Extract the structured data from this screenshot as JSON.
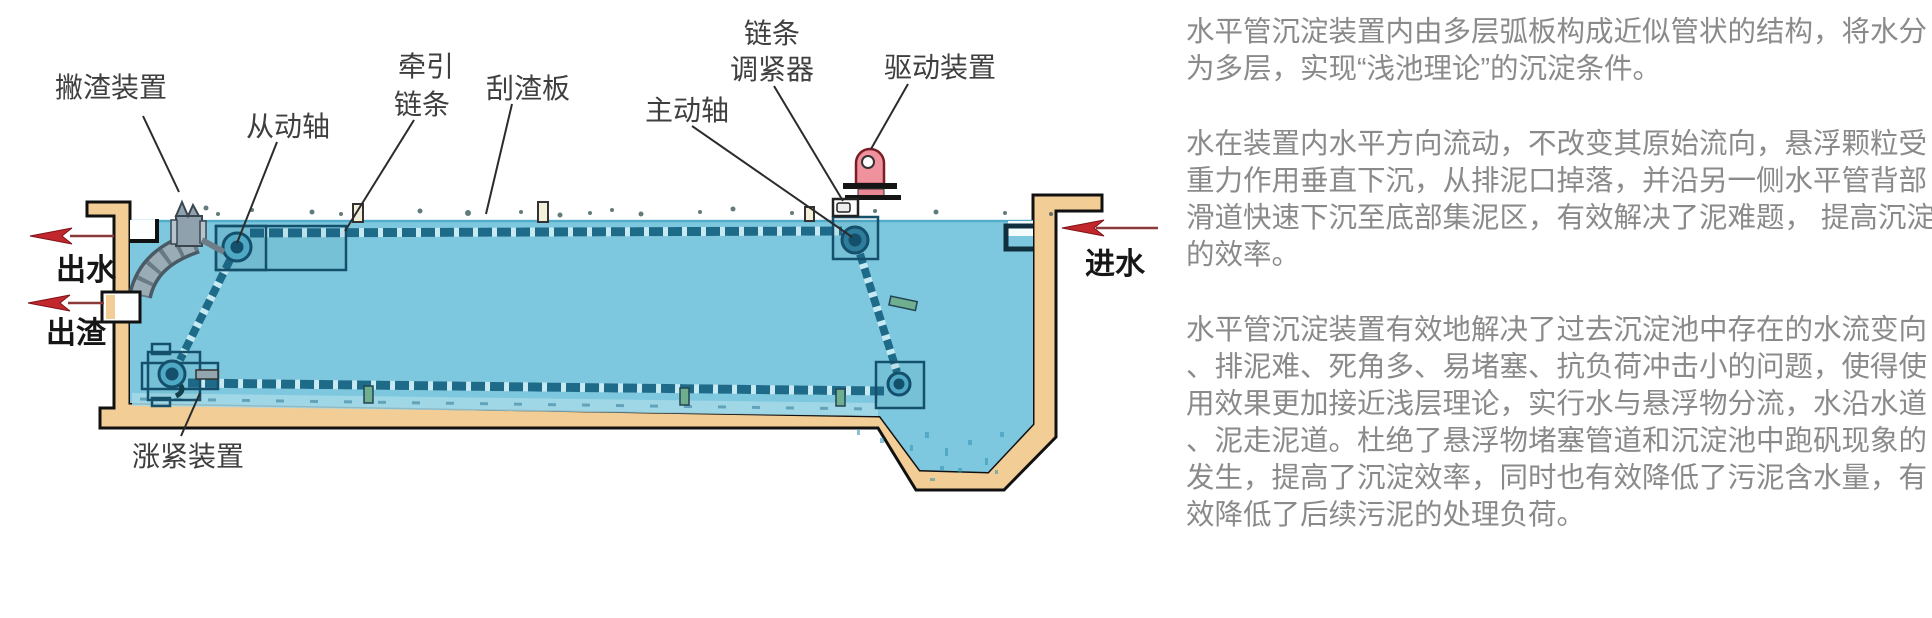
{
  "diagram": {
    "labels": {
      "skimmer": "撇渣装置",
      "driven_shaft": "从动轴",
      "traction_chain_l1": "牵引",
      "traction_chain_l2": "链条",
      "scraper_plate": "刮渣板",
      "drive_shaft": "主动轴",
      "tensioner_l1": "链条",
      "tensioner_l2": "调紧器",
      "drive_unit": "驱动装置",
      "tension_device": "涨紧装置",
      "water_out": "出水",
      "slag_out": "出渣",
      "water_in": "进水"
    },
    "colors": {
      "wall": "#F2CD96",
      "water": "#7EC8DF",
      "chain_dark": "#1D6A89",
      "chain_light": "#C6E9F2",
      "arrow_red": "#C2272D",
      "motor_pink": "#F0919E",
      "chute_gray": "#9AACB6",
      "outline": "#111111"
    }
  },
  "description": {
    "paragraphs": [
      "水平管沉淀装置内由多层弧板构成近似管状的结构，将水分\n为多层，实现“浅池理论”的沉淀条件。",
      "水在装置内水平方向流动，不改变其原始流向，悬浮颗粒受\n重力作用垂直下沉，从排泥口掉落，并沿另一侧水平管背部\n滑道快速下沉至底部集泥区，有效解决了泥难题， 提高沉淀\n的效率。",
      "水平管沉淀装置有效地解决了过去沉淀池中存在的水流变向\n、排泥难、死角多、易堵塞、抗负荷冲击小的问题，使得使\n用效果更加接近浅层理论，实行水与悬浮物分流，水沿水道\n、泥走泥道。杜绝了悬浮物堵塞管道和沉淀池中跑矾现象的\n发生，提高了沉淀效率，同时也有效降低了污泥含水量，有\n效降低了后续污泥的处理负荷。"
    ]
  }
}
